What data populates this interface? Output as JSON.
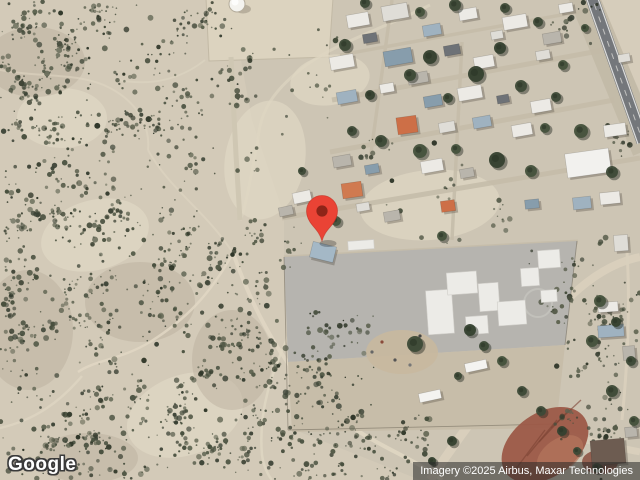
{
  "branding": {
    "logo_text": "Google"
  },
  "attribution": {
    "text": "Imagery ©2025 Airbus, Maxar Technologies"
  },
  "map": {
    "description": "Satellite view of a desert town with scrubland, a school lot and a highway",
    "marker": {
      "x": 322,
      "y": 241,
      "fill": "#EA4335",
      "dot": "#8E2418",
      "outline": "#C0291D"
    },
    "colors": {
      "desert_base": "#d3cab8",
      "scrub_vegetation": "#49503f",
      "paved_lot": "#b6b4af",
      "highway": "#74777b",
      "red_soil": "#9c5a48",
      "roof_orange": "#cd6f47",
      "roof_blue": "#9fb2c0",
      "roof_white": "#eceae5"
    }
  }
}
